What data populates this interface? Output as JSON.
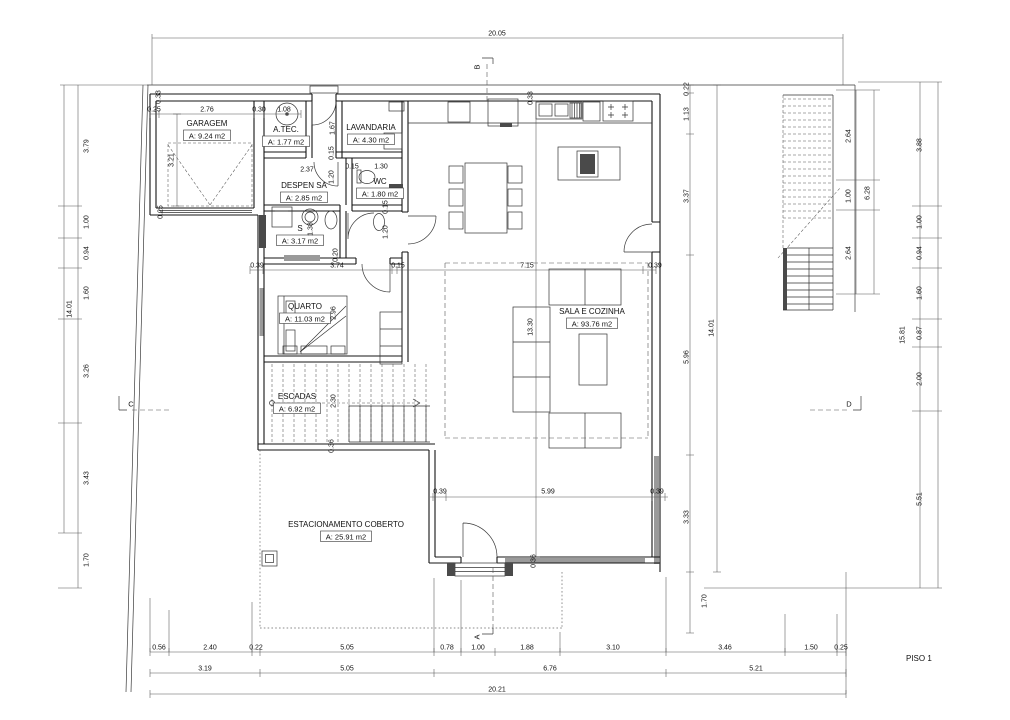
{
  "drawing": {
    "floor_label": "PISO 1",
    "rooms": [
      {
        "name": "GARAGEM",
        "area": "A: 9.24 m2",
        "x": 207,
        "y": 126
      },
      {
        "name": "A.TEC.",
        "area": "A: 1.77 m2",
        "x": 286,
        "y": 132
      },
      {
        "name": "LAVANDARIA",
        "area": "A: 4.30 m2",
        "x": 371,
        "y": 130
      },
      {
        "name": "DESPEN SA",
        "area": "A: 2.85 m2",
        "x": 304,
        "y": 188
      },
      {
        "name": "WC",
        "area": "A: 1.80 m2",
        "x": 380,
        "y": 184
      },
      {
        "name": "S",
        "area": "A: 3.17 m2",
        "x": 300,
        "y": 231
      },
      {
        "name": "QUARTO",
        "area": "A: 11.03 m2",
        "x": 305,
        "y": 309
      },
      {
        "name": "ESCADAS",
        "area": "A: 6.92 m2",
        "x": 297,
        "y": 399
      },
      {
        "name": "SALA E COZINHA",
        "area": "A: 93.76 m2",
        "x": 592,
        "y": 314
      },
      {
        "name": "ESTACIONAMENTO COBERTO",
        "area": "A: 25.91 m2",
        "x": 346,
        "y": 527
      }
    ],
    "dims": [
      {
        "t": "20.05",
        "x": 497,
        "y": 34,
        "r": 0
      },
      {
        "t": "0.33",
        "x": 159,
        "y": 97,
        "r": 1
      },
      {
        "t": "0.25",
        "x": 154,
        "y": 110,
        "r": 0
      },
      {
        "t": "2.76",
        "x": 207,
        "y": 110,
        "r": 0
      },
      {
        "t": "0.30",
        "x": 259,
        "y": 110,
        "r": 0
      },
      {
        "t": "1.08",
        "x": 284,
        "y": 110,
        "r": 0
      },
      {
        "t": "3.21",
        "x": 172,
        "y": 160,
        "r": 1
      },
      {
        "t": "0.25",
        "x": 161,
        "y": 212,
        "r": 1
      },
      {
        "t": "1.67",
        "x": 333,
        "y": 128,
        "r": 1
      },
      {
        "t": "0.33",
        "x": 531,
        "y": 98,
        "r": 1
      },
      {
        "t": "2.37",
        "x": 307,
        "y": 170,
        "r": 0
      },
      {
        "t": "0.15",
        "x": 352,
        "y": 167,
        "r": 0
      },
      {
        "t": "1.30",
        "x": 381,
        "y": 167,
        "r": 0
      },
      {
        "t": "0.15",
        "x": 332,
        "y": 153,
        "r": 1
      },
      {
        "t": "1.20",
        "x": 332,
        "y": 177,
        "r": 1
      },
      {
        "t": "0.15",
        "x": 386,
        "y": 207,
        "r": 1
      },
      {
        "t": "1.20",
        "x": 386,
        "y": 232,
        "r": 1
      },
      {
        "t": "1.38",
        "x": 311,
        "y": 229,
        "r": 1
      },
      {
        "t": "0.20",
        "x": 336,
        "y": 255,
        "r": 1
      },
      {
        "t": "2.96",
        "x": 334,
        "y": 313,
        "r": 1
      },
      {
        "t": "2.30",
        "x": 334,
        "y": 401,
        "r": 1
      },
      {
        "t": "0.36",
        "x": 332,
        "y": 446,
        "r": 1
      },
      {
        "t": "0.39",
        "x": 257,
        "y": 266,
        "r": 0
      },
      {
        "t": "3.74",
        "x": 337,
        "y": 266,
        "r": 0
      },
      {
        "t": "0.15",
        "x": 398,
        "y": 266,
        "r": 0
      },
      {
        "t": "7.15",
        "x": 527,
        "y": 266,
        "r": 0
      },
      {
        "t": "0.39",
        "x": 655,
        "y": 266,
        "r": 0
      },
      {
        "t": "13.30",
        "x": 531,
        "y": 327,
        "r": 1
      },
      {
        "t": "0.22",
        "x": 687,
        "y": 89,
        "r": 1
      },
      {
        "t": "1.13",
        "x": 687,
        "y": 114,
        "r": 1
      },
      {
        "t": "3.37",
        "x": 687,
        "y": 196,
        "r": 1
      },
      {
        "t": "5.96",
        "x": 687,
        "y": 357,
        "r": 1
      },
      {
        "t": "3.33",
        "x": 687,
        "y": 517,
        "r": 1
      },
      {
        "t": "1.70",
        "x": 705,
        "y": 601,
        "r": 1
      },
      {
        "t": "14.01",
        "x": 712,
        "y": 328,
        "r": 1
      },
      {
        "t": "2.64",
        "x": 849,
        "y": 136,
        "r": 1
      },
      {
        "t": "1.00",
        "x": 849,
        "y": 196,
        "r": 1
      },
      {
        "t": "2.64",
        "x": 849,
        "y": 253,
        "r": 1
      },
      {
        "t": "6.28",
        "x": 868,
        "y": 193,
        "r": 1
      },
      {
        "t": "3.88",
        "x": 920,
        "y": 145,
        "r": 1
      },
      {
        "t": "1.00",
        "x": 920,
        "y": 222,
        "r": 1
      },
      {
        "t": "0.94",
        "x": 920,
        "y": 253,
        "r": 1
      },
      {
        "t": "1.60",
        "x": 920,
        "y": 293,
        "r": 1
      },
      {
        "t": "0.87",
        "x": 920,
        "y": 333,
        "r": 1
      },
      {
        "t": "2.00",
        "x": 920,
        "y": 379,
        "r": 1
      },
      {
        "t": "5.51",
        "x": 920,
        "y": 499,
        "r": 1
      },
      {
        "t": "15.81",
        "x": 903,
        "y": 335,
        "r": 1
      },
      {
        "t": "3.79",
        "x": 87,
        "y": 146,
        "r": 1
      },
      {
        "t": "1.00",
        "x": 87,
        "y": 222,
        "r": 1
      },
      {
        "t": "0.94",
        "x": 87,
        "y": 253,
        "r": 1
      },
      {
        "t": "1.60",
        "x": 87,
        "y": 293,
        "r": 1
      },
      {
        "t": "3.26",
        "x": 87,
        "y": 371,
        "r": 1
      },
      {
        "t": "3.43",
        "x": 87,
        "y": 478,
        "r": 1
      },
      {
        "t": "1.70",
        "x": 87,
        "y": 560,
        "r": 1
      },
      {
        "t": "14.01",
        "x": 70,
        "y": 309,
        "r": 1
      },
      {
        "t": "0.39",
        "x": 440,
        "y": 492,
        "r": 0
      },
      {
        "t": "5.99",
        "x": 548,
        "y": 492,
        "r": 0
      },
      {
        "t": "0.39",
        "x": 657,
        "y": 492,
        "r": 0
      },
      {
        "t": "0.36",
        "x": 534,
        "y": 561,
        "r": 1
      },
      {
        "t": "0.56",
        "x": 159,
        "y": 648,
        "r": 0
      },
      {
        "t": "2.40",
        "x": 210,
        "y": 648,
        "r": 0
      },
      {
        "t": "0.22",
        "x": 256,
        "y": 648,
        "r": 0
      },
      {
        "t": "5.05",
        "x": 347,
        "y": 648,
        "r": 0
      },
      {
        "t": "0.78",
        "x": 447,
        "y": 648,
        "r": 0
      },
      {
        "t": "1.00",
        "x": 478,
        "y": 648,
        "r": 0
      },
      {
        "t": "1.88",
        "x": 527,
        "y": 648,
        "r": 0
      },
      {
        "t": "3.10",
        "x": 613,
        "y": 648,
        "r": 0
      },
      {
        "t": "3.46",
        "x": 725,
        "y": 648,
        "r": 0
      },
      {
        "t": "1.50",
        "x": 811,
        "y": 648,
        "r": 0
      },
      {
        "t": "0.25",
        "x": 841,
        "y": 648,
        "r": 0
      },
      {
        "t": "3.19",
        "x": 205,
        "y": 669,
        "r": 0
      },
      {
        "t": "5.05",
        "x": 347,
        "y": 669,
        "r": 0
      },
      {
        "t": "6.76",
        "x": 550,
        "y": 669,
        "r": 0
      },
      {
        "t": "5.21",
        "x": 756,
        "y": 669,
        "r": 0
      },
      {
        "t": "20.21",
        "x": 497,
        "y": 690,
        "r": 0
      }
    ],
    "markers": [
      {
        "label": "A",
        "x": 477,
        "y": 637,
        "r": 1
      },
      {
        "label": "B",
        "x": 477,
        "y": 67,
        "r": 1
      },
      {
        "label": "C",
        "x": 131,
        "y": 404,
        "r": 0
      },
      {
        "label": "D",
        "x": 849,
        "y": 404,
        "r": 0
      }
    ]
  }
}
